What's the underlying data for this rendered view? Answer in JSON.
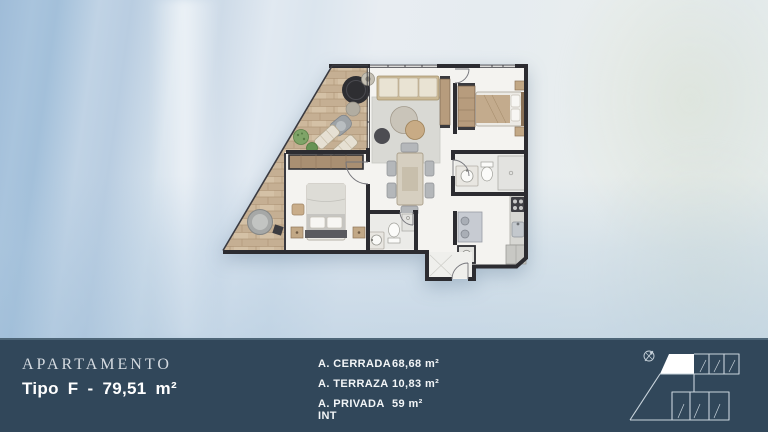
{
  "slide": {
    "title": "APARTAMENTO",
    "subtitle": "Tipo F - 79,51 m²"
  },
  "areas": [
    {
      "label": "A. CERRADA",
      "value": "68,68 m²"
    },
    {
      "label": "A. TERRAZA",
      "value": "10,83 m²"
    },
    {
      "label": "A. PRIVADA INT",
      "value": "59 m²"
    }
  ],
  "icons": {
    "keyplan_compass": "north-arrow"
  },
  "colors": {
    "bar_background": "#31475a",
    "bar_top_line": "#4d6577",
    "title_color": "#d5dbe1",
    "text_white": "#ffffff",
    "wall_color": "#2c2c31",
    "terrace_wood": "#cdb89c",
    "background_blue": "#9fbcd8",
    "keyplan_line": "#c9d4dc",
    "keyplan_highlight": "#ffffff"
  }
}
